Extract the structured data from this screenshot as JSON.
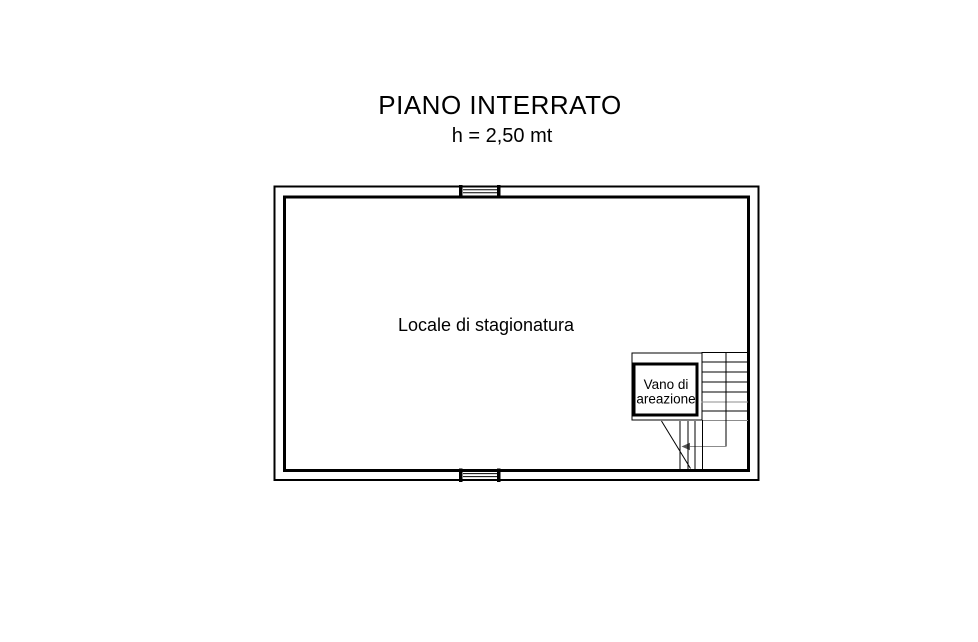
{
  "title": {
    "text": "PIANO INTERRATO",
    "height_note": "h = 2,50 mt"
  },
  "plan": {
    "room_label": "Locale di stagionatura",
    "ventilation_shaft": {
      "label_line1": "Vano di",
      "label_line2": "areazione"
    }
  },
  "colors": {
    "ink": "#000000",
    "stair_gray": "#8c8c8c",
    "background": "#ffffff"
  }
}
